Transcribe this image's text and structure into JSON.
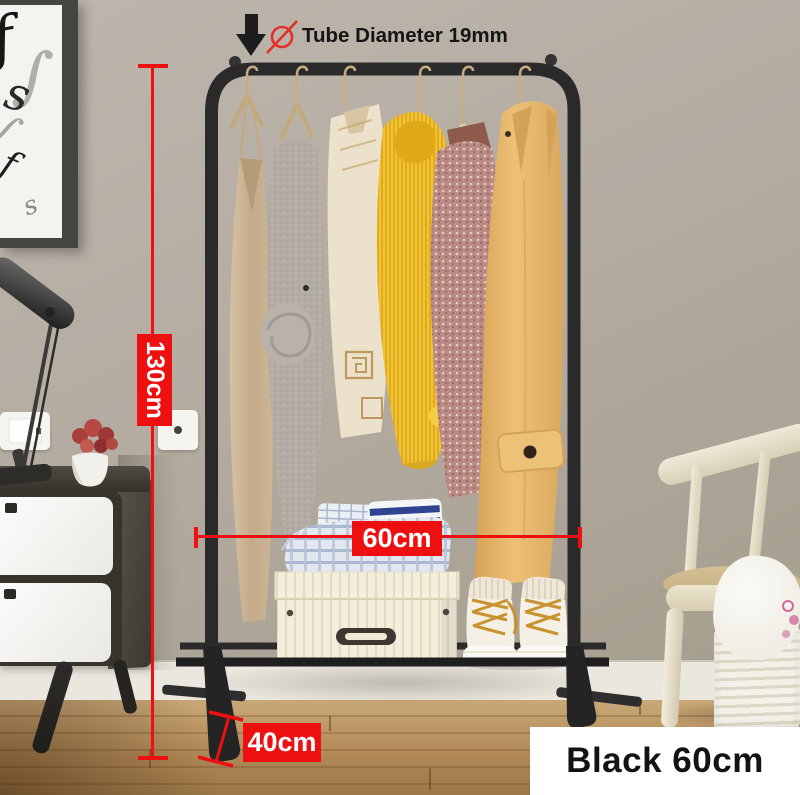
{
  "annotations": {
    "tube_diameter": {
      "label": "Tube Diameter 19mm",
      "icons": {
        "down_arrow": {
          "name": "down-arrow-icon",
          "glyph": "↓"
        },
        "diameter": {
          "name": "diameter-icon",
          "glyph": "Ø"
        }
      }
    },
    "height": {
      "label": "130cm"
    },
    "rail_width": {
      "label": "60cm"
    },
    "base_depth": {
      "label": "40cm"
    },
    "variant": {
      "label": "Black 60cm"
    }
  },
  "colors": {
    "dimension_accent": "#ee1010",
    "dimension_text": "#ffffff",
    "annotation_text": "#141414",
    "rack_frame": "#262626",
    "variant_badge_bg": "#ffffff",
    "variant_badge_text": "#131313",
    "wall": "#b3aba0",
    "floor": "#b28a58"
  }
}
